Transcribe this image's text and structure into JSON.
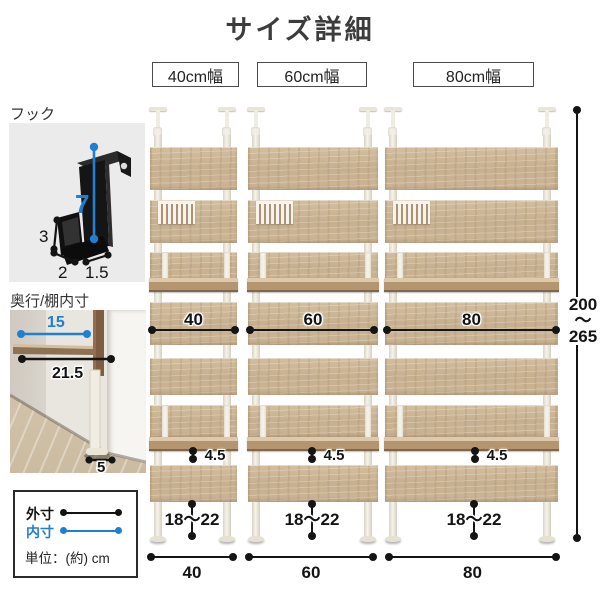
{
  "title": "サイズ詳細",
  "colors": {
    "accent_blue": "#1f7fd1",
    "measure_black": "#141414",
    "wood": "#c9b292"
  },
  "hook": {
    "label": "フック",
    "height": "7",
    "side": "3",
    "depth": "2",
    "width": "1.5"
  },
  "depth": {
    "label": "奥行/棚内寸",
    "inner_depth": "15",
    "outer_depth": "21.5",
    "foot_depth": "5"
  },
  "legend": {
    "outer": "外寸",
    "inner": "内寸",
    "unit_note": "単位：(約) cm"
  },
  "height_range": {
    "min": "200",
    "wave": "〜",
    "max": "265"
  },
  "units": [
    {
      "header": "40cm幅",
      "inner_width": "40",
      "outer_width": "40",
      "shelf_gap": "4.5",
      "floor_gap": "18〜22"
    },
    {
      "header": "60cm幅",
      "inner_width": "60",
      "outer_width": "60",
      "shelf_gap": "4.5",
      "floor_gap": "18〜22"
    },
    {
      "header": "80cm幅",
      "inner_width": "80",
      "outer_width": "80",
      "shelf_gap": "4.5",
      "floor_gap": "18〜22"
    }
  ]
}
